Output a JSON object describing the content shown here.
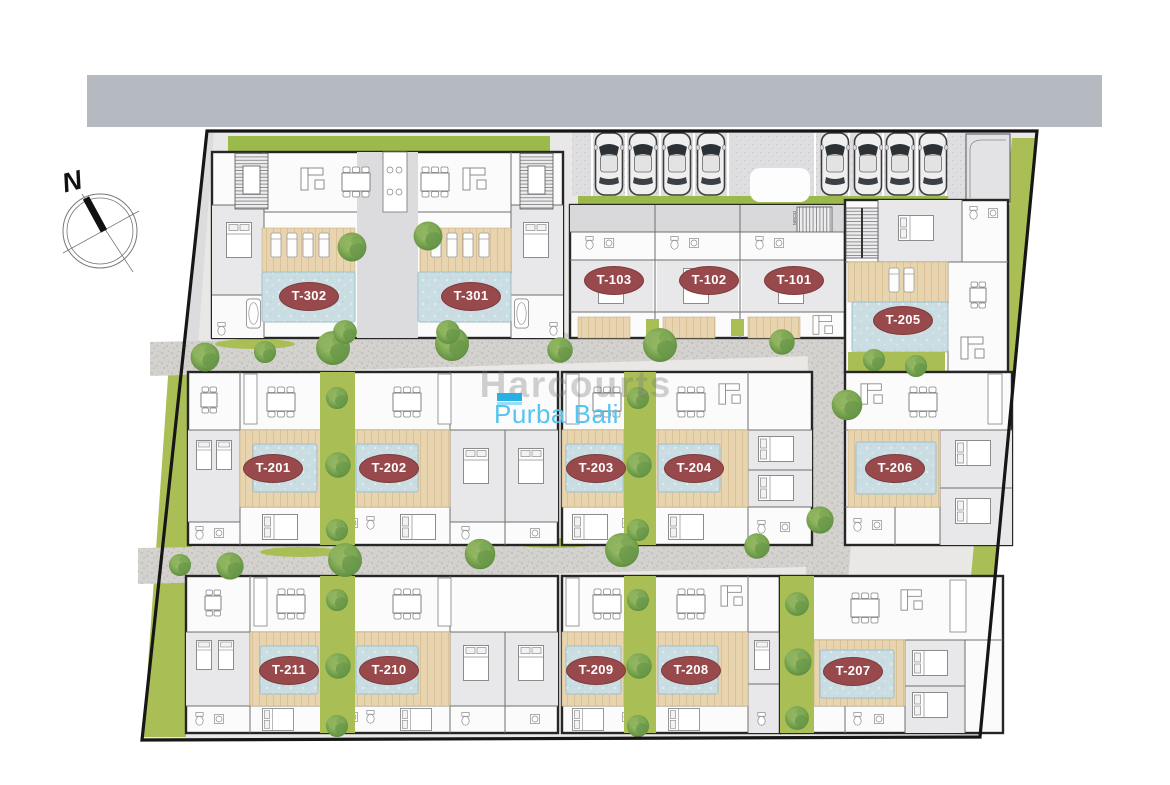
{
  "plan": {
    "compass": {
      "label": "N"
    },
    "stairs": {
      "down_label": "DOWN"
    },
    "watermark": {
      "brand": "Harcourts",
      "location": "Purba Bali"
    },
    "units": [
      {
        "label": "T-302"
      },
      {
        "label": "T-301"
      },
      {
        "label": "T-103"
      },
      {
        "label": "T-102"
      },
      {
        "label": "T-101"
      },
      {
        "label": "T-205"
      },
      {
        "label": "T-201"
      },
      {
        "label": "T-202"
      },
      {
        "label": "T-203"
      },
      {
        "label": "T-204"
      },
      {
        "label": "T-206"
      },
      {
        "label": "T-211"
      },
      {
        "label": "T-210"
      },
      {
        "label": "T-209"
      },
      {
        "label": "T-208"
      },
      {
        "label": "T-207"
      }
    ],
    "colors": {
      "road": "#b5b9c0",
      "lawn": "#a9bf55",
      "pool": "#c9dde3",
      "deck": "#e8d4ae",
      "gravel": "#d4d2ce",
      "unit_label_bg": "#97494b",
      "watermark_blue": "#55c4f0"
    }
  }
}
